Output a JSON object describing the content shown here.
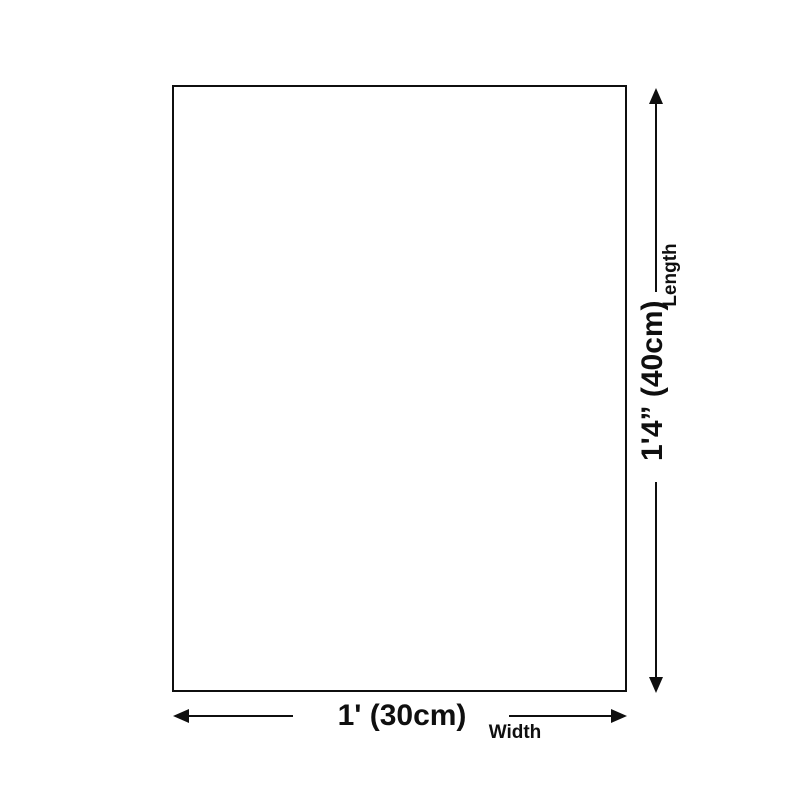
{
  "diagram": {
    "type": "product-dimension-diagram",
    "background_color": "#ffffff",
    "line_color": "#0f0f0f",
    "product_box": {
      "shape": "rectangle",
      "fill": "#ffffff",
      "border_color": "#0f0f0f"
    },
    "length_dimension": {
      "value": "1'4” (40cm)",
      "label": "Length",
      "orientation": "vertical"
    },
    "width_dimension": {
      "value": "1' (30cm)",
      "label": "Width",
      "orientation": "horizontal"
    }
  }
}
